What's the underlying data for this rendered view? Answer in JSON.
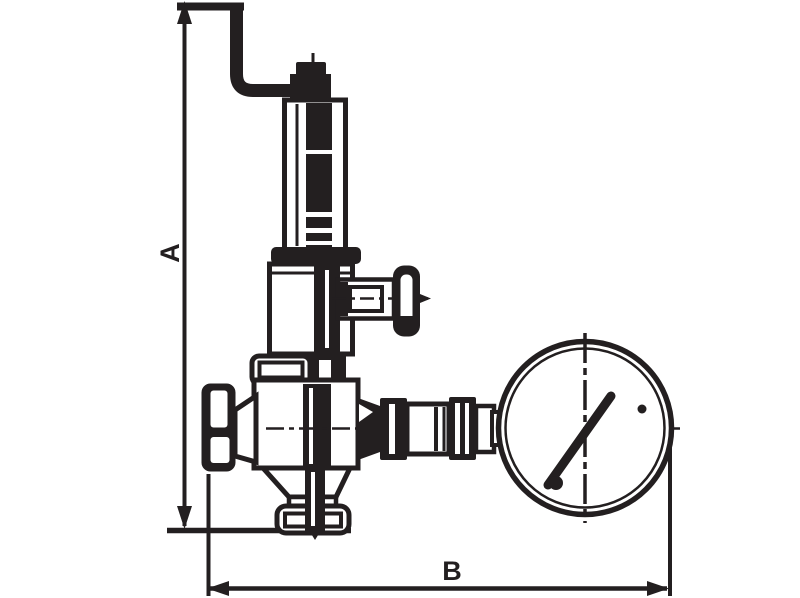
{
  "figure": {
    "dim_label_vertical": "A",
    "dim_label_horizontal": "B"
  },
  "colors": {
    "ink": "#231f20",
    "background": "#ffffff"
  }
}
